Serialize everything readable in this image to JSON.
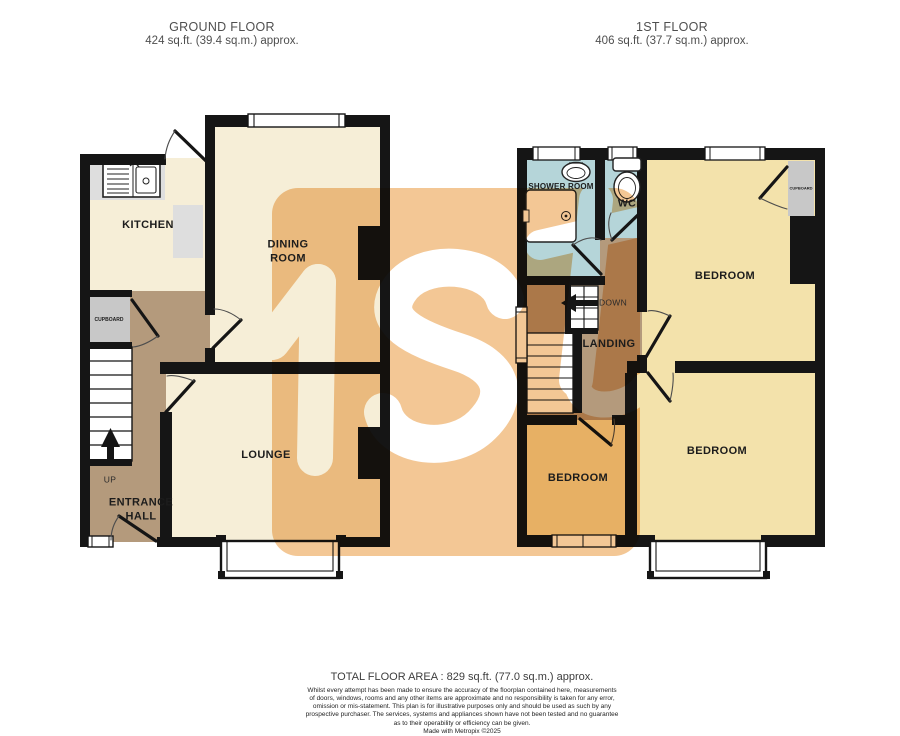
{
  "ground_floor": {
    "title": "GROUND FLOOR",
    "area": "424 sq.ft. (39.4 sq.m.) approx.",
    "labels": {
      "kitchen": "KITCHEN",
      "dining_room": "DINING\nROOM",
      "lounge": "LOUNGE",
      "cupboard": "CUPBOARD",
      "up": "UP",
      "entrance_hall": "ENTRANCE\nHALL"
    }
  },
  "first_floor": {
    "title": "1ST FLOOR",
    "area": "406 sq.ft. (37.7 sq.m.) approx.",
    "labels": {
      "shower_room": "SHOWER ROOM",
      "wc": "WC",
      "down": "DOWN",
      "landing": "LANDING",
      "bedroom_front": "BEDROOM",
      "bedroom_back": "BEDROOM",
      "bedroom_small": "BEDROOM",
      "cupboard": "CUPBOARD"
    }
  },
  "footer": {
    "total_area": "TOTAL FLOOR AREA : 829 sq.ft. (77.0 sq.m.) approx.",
    "disclaimer": "Whilst every attempt has been made to ensure the accuracy of the floorplan contained here, measurements\nof doors, windows, rooms and any other items are approximate and no responsibility is taken for any error,\nomission or mis-statement. This plan is for illustrative purposes only and should be used as such by any\nprospective purchaser. The services, systems and appliances shown have not been tested and no guarantee\nas to their operability or efficiency can be given.",
    "credit": "Made with Metropix ©2025"
  },
  "colors": {
    "wall": "#151515",
    "room_cream": "#f6eed7",
    "room_yellow": "#f3e2ab",
    "hall_tan": "#b49a7c",
    "bathroom_blue": "#b5d5d9",
    "cupboard_gray": "#c8c8c8",
    "counter_gray": "#dedede",
    "watermark_orange": "#f3c795"
  }
}
